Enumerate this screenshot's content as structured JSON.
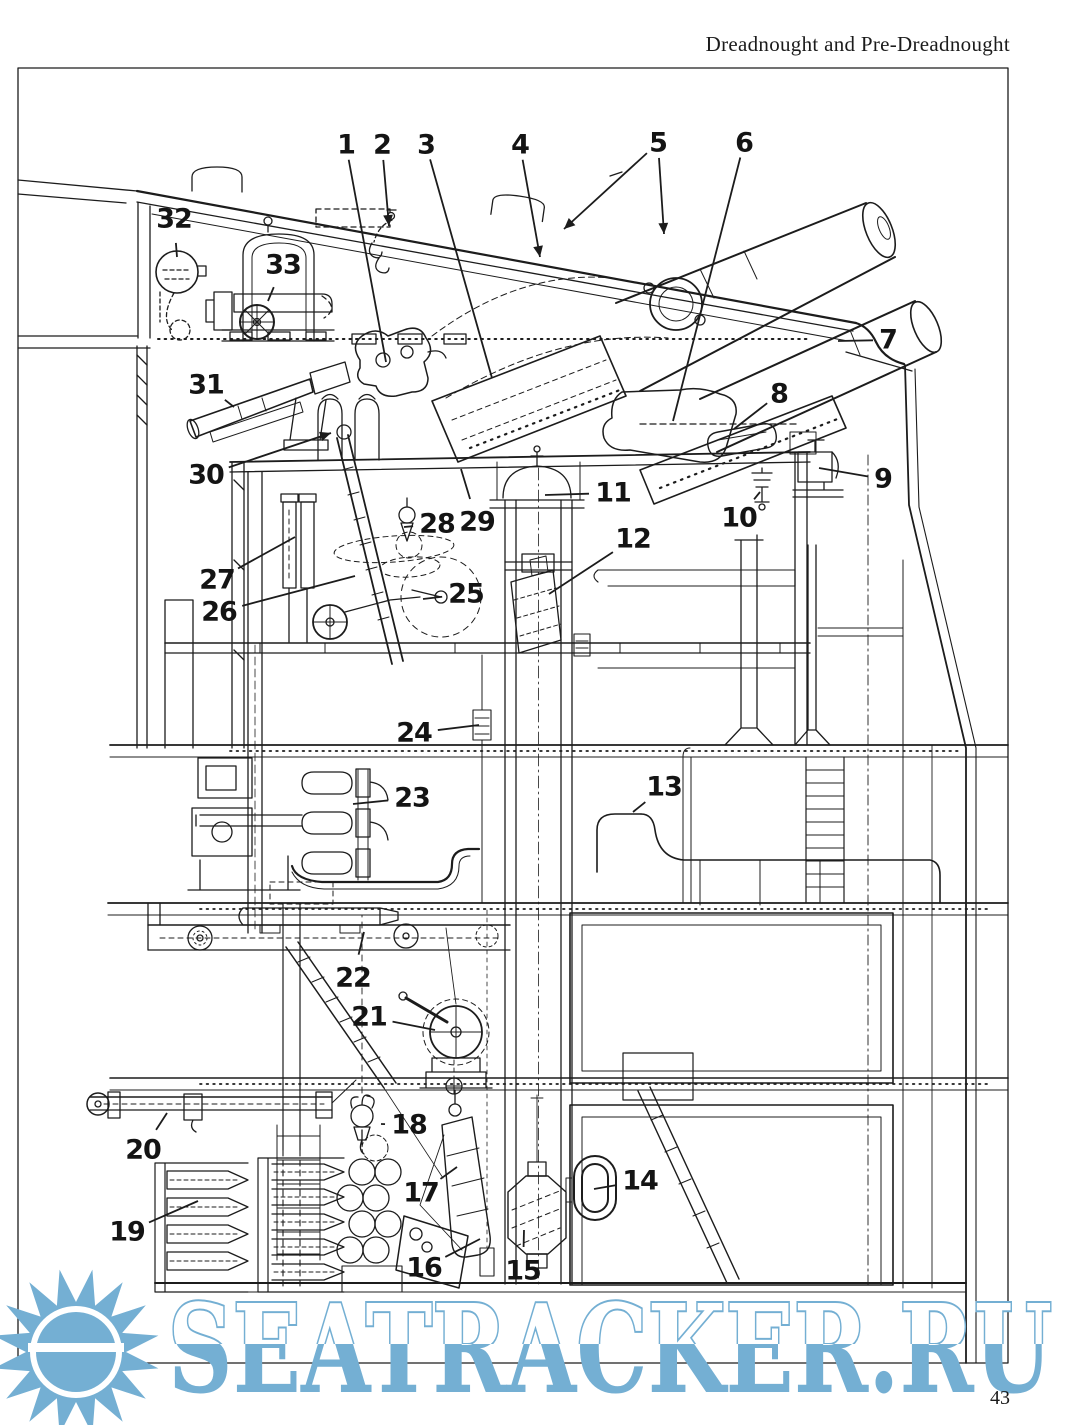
{
  "page": {
    "width": 1080,
    "height": 1425,
    "background": "#ffffff",
    "ink": "#1c1c1c"
  },
  "header": {
    "title": "Dreadnought and Pre-Dreadnought"
  },
  "footer": {
    "page_number": "43"
  },
  "watermark": {
    "text": "SEATRACKER.RU",
    "color": "#74afd3",
    "icon": "sun-logo"
  },
  "figure": {
    "subject": "Cutaway section of a pre-dreadnought twin-gun turret, barbette, ammunition trunk and magazines",
    "callouts": [
      {
        "n": "1",
        "x": 346,
        "y": 145,
        "leaders": [
          [
            386,
            362,
            false
          ]
        ]
      },
      {
        "n": "2",
        "x": 382,
        "y": 145,
        "leaders": [
          [
            389,
            226,
            true
          ]
        ]
      },
      {
        "n": "3",
        "x": 426,
        "y": 145,
        "leaders": [
          [
            492,
            378,
            false
          ]
        ]
      },
      {
        "n": "4",
        "x": 520,
        "y": 145,
        "leaders": [
          [
            540,
            257,
            true
          ]
        ]
      },
      {
        "n": "5",
        "x": 658,
        "y": 143,
        "leaders": [
          [
            564,
            229,
            true
          ],
          [
            664,
            234,
            true
          ]
        ]
      },
      {
        "n": "6",
        "x": 744,
        "y": 143,
        "leaders": [
          [
            673,
            421,
            false
          ]
        ]
      },
      {
        "n": "7",
        "x": 888,
        "y": 340,
        "leaders": [
          [
            838,
            341,
            false
          ]
        ]
      },
      {
        "n": "8",
        "x": 779,
        "y": 394,
        "leaders": [
          [
            734,
            429,
            false
          ]
        ]
      },
      {
        "n": "9",
        "x": 883,
        "y": 479,
        "leaders": [
          [
            819,
            468,
            false
          ]
        ]
      },
      {
        "n": "10",
        "x": 739,
        "y": 518,
        "leaders": [
          [
            760,
            492,
            false
          ]
        ]
      },
      {
        "n": "11",
        "x": 613,
        "y": 493,
        "leaders": [
          [
            545,
            495,
            false
          ]
        ]
      },
      {
        "n": "12",
        "x": 633,
        "y": 539,
        "leaders": [
          [
            549,
            594,
            false
          ]
        ]
      },
      {
        "n": "13",
        "x": 664,
        "y": 787,
        "leaders": [
          [
            633,
            812,
            false
          ]
        ]
      },
      {
        "n": "14",
        "x": 640,
        "y": 1181,
        "leaders": [
          [
            594,
            1189,
            false
          ]
        ]
      },
      {
        "n": "15",
        "x": 523,
        "y": 1271,
        "leaders": [
          [
            524,
            1230,
            false
          ]
        ]
      },
      {
        "n": "16",
        "x": 424,
        "y": 1268,
        "leaders": [
          [
            480,
            1239,
            false
          ]
        ]
      },
      {
        "n": "17",
        "x": 421,
        "y": 1193,
        "leaders": [
          [
            457,
            1167,
            false
          ]
        ]
      },
      {
        "n": "18",
        "x": 409,
        "y": 1125,
        "leaders": [
          [
            381,
            1124,
            false
          ]
        ]
      },
      {
        "n": "19",
        "x": 127,
        "y": 1232,
        "leaders": [
          [
            198,
            1201,
            false
          ]
        ]
      },
      {
        "n": "20",
        "x": 143,
        "y": 1150,
        "leaders": [
          [
            167,
            1113,
            false
          ]
        ]
      },
      {
        "n": "21",
        "x": 369,
        "y": 1017,
        "leaders": [
          [
            435,
            1030,
            false
          ]
        ]
      },
      {
        "n": "22",
        "x": 353,
        "y": 978,
        "leaders": [
          [
            364,
            932,
            false
          ]
        ]
      },
      {
        "n": "23",
        "x": 412,
        "y": 798,
        "leaders": [
          [
            353,
            804,
            false
          ]
        ]
      },
      {
        "n": "24",
        "x": 414,
        "y": 733,
        "leaders": [
          [
            479,
            725,
            false
          ]
        ]
      },
      {
        "n": "25",
        "x": 466,
        "y": 594,
        "leaders": [
          [
            423,
            599,
            false
          ]
        ]
      },
      {
        "n": "26",
        "x": 219,
        "y": 612,
        "leaders": [
          [
            355,
            576,
            false
          ]
        ]
      },
      {
        "n": "27",
        "x": 217,
        "y": 580,
        "leaders": [
          [
            295,
            537,
            false
          ]
        ]
      },
      {
        "n": "28",
        "x": 437,
        "y": 524,
        "leaders": [
          [
            404,
            527,
            false
          ]
        ]
      },
      {
        "n": "29",
        "x": 477,
        "y": 522,
        "leaders": [
          [
            461,
            469,
            false
          ]
        ]
      },
      {
        "n": "30",
        "x": 206,
        "y": 475,
        "leaders": [
          [
            331,
            433,
            true
          ]
        ]
      },
      {
        "n": "31",
        "x": 206,
        "y": 385,
        "leaders": [
          [
            234,
            407,
            false
          ]
        ]
      },
      {
        "n": "32",
        "x": 174,
        "y": 219,
        "leaders": [
          [
            177,
            257,
            false
          ]
        ]
      },
      {
        "n": "33",
        "x": 283,
        "y": 265,
        "leaders": [
          [
            268,
            301,
            false
          ]
        ]
      }
    ]
  }
}
